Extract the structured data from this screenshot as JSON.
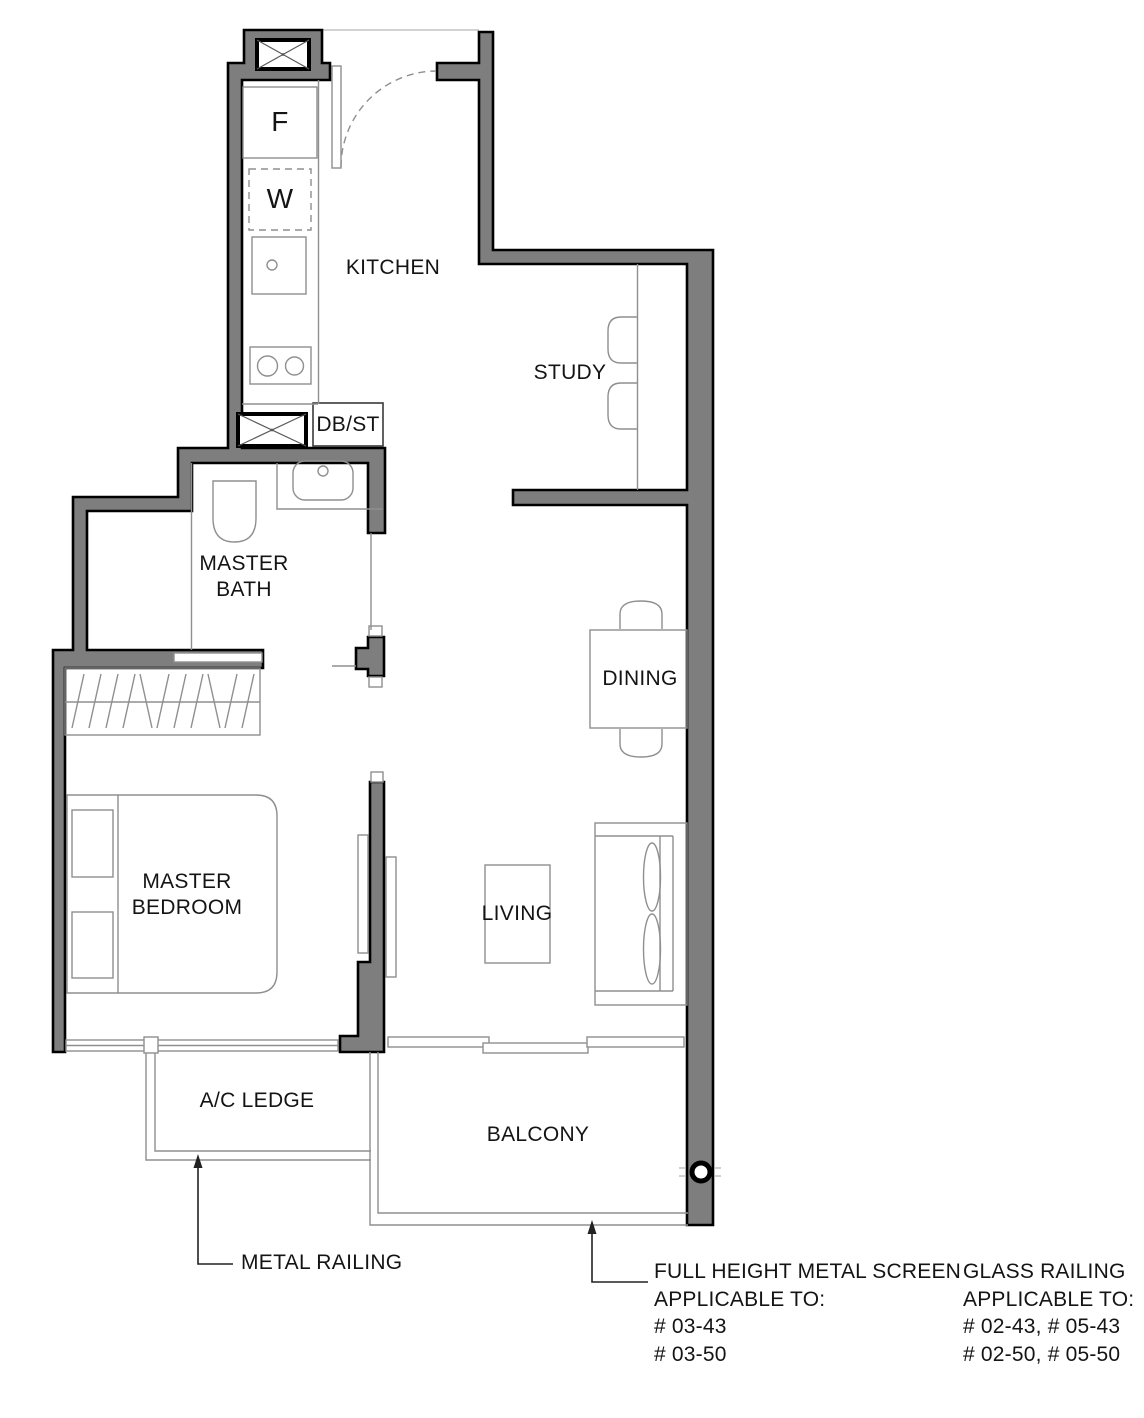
{
  "rooms": {
    "kitchen": "KITCHEN",
    "study": "STUDY",
    "master_bath": "MASTER\nBATH",
    "dining": "DINING",
    "master_bedroom": "MASTER\nBEDROOM",
    "living": "LIVING",
    "ac_ledge": "A/C LEDGE",
    "balcony": "BALCONY"
  },
  "fixtures": {
    "fridge": "F",
    "washer": "W",
    "db_st": "DB/ST"
  },
  "annotations": {
    "metal_railing": "METAL RAILING",
    "full_height_screen": "FULL HEIGHT METAL SCREEN\nAPPLICABLE TO:\n# 03-43\n# 03-50",
    "glass_railing": "GLASS RAILING\nAPPLICABLE TO:\n# 02-43, # 05-43\n# 02-50, # 05-50"
  },
  "colors": {
    "wall": "#7e7e7e",
    "outline": "#000000",
    "line": "#8f8f8f",
    "text": "#141414"
  }
}
